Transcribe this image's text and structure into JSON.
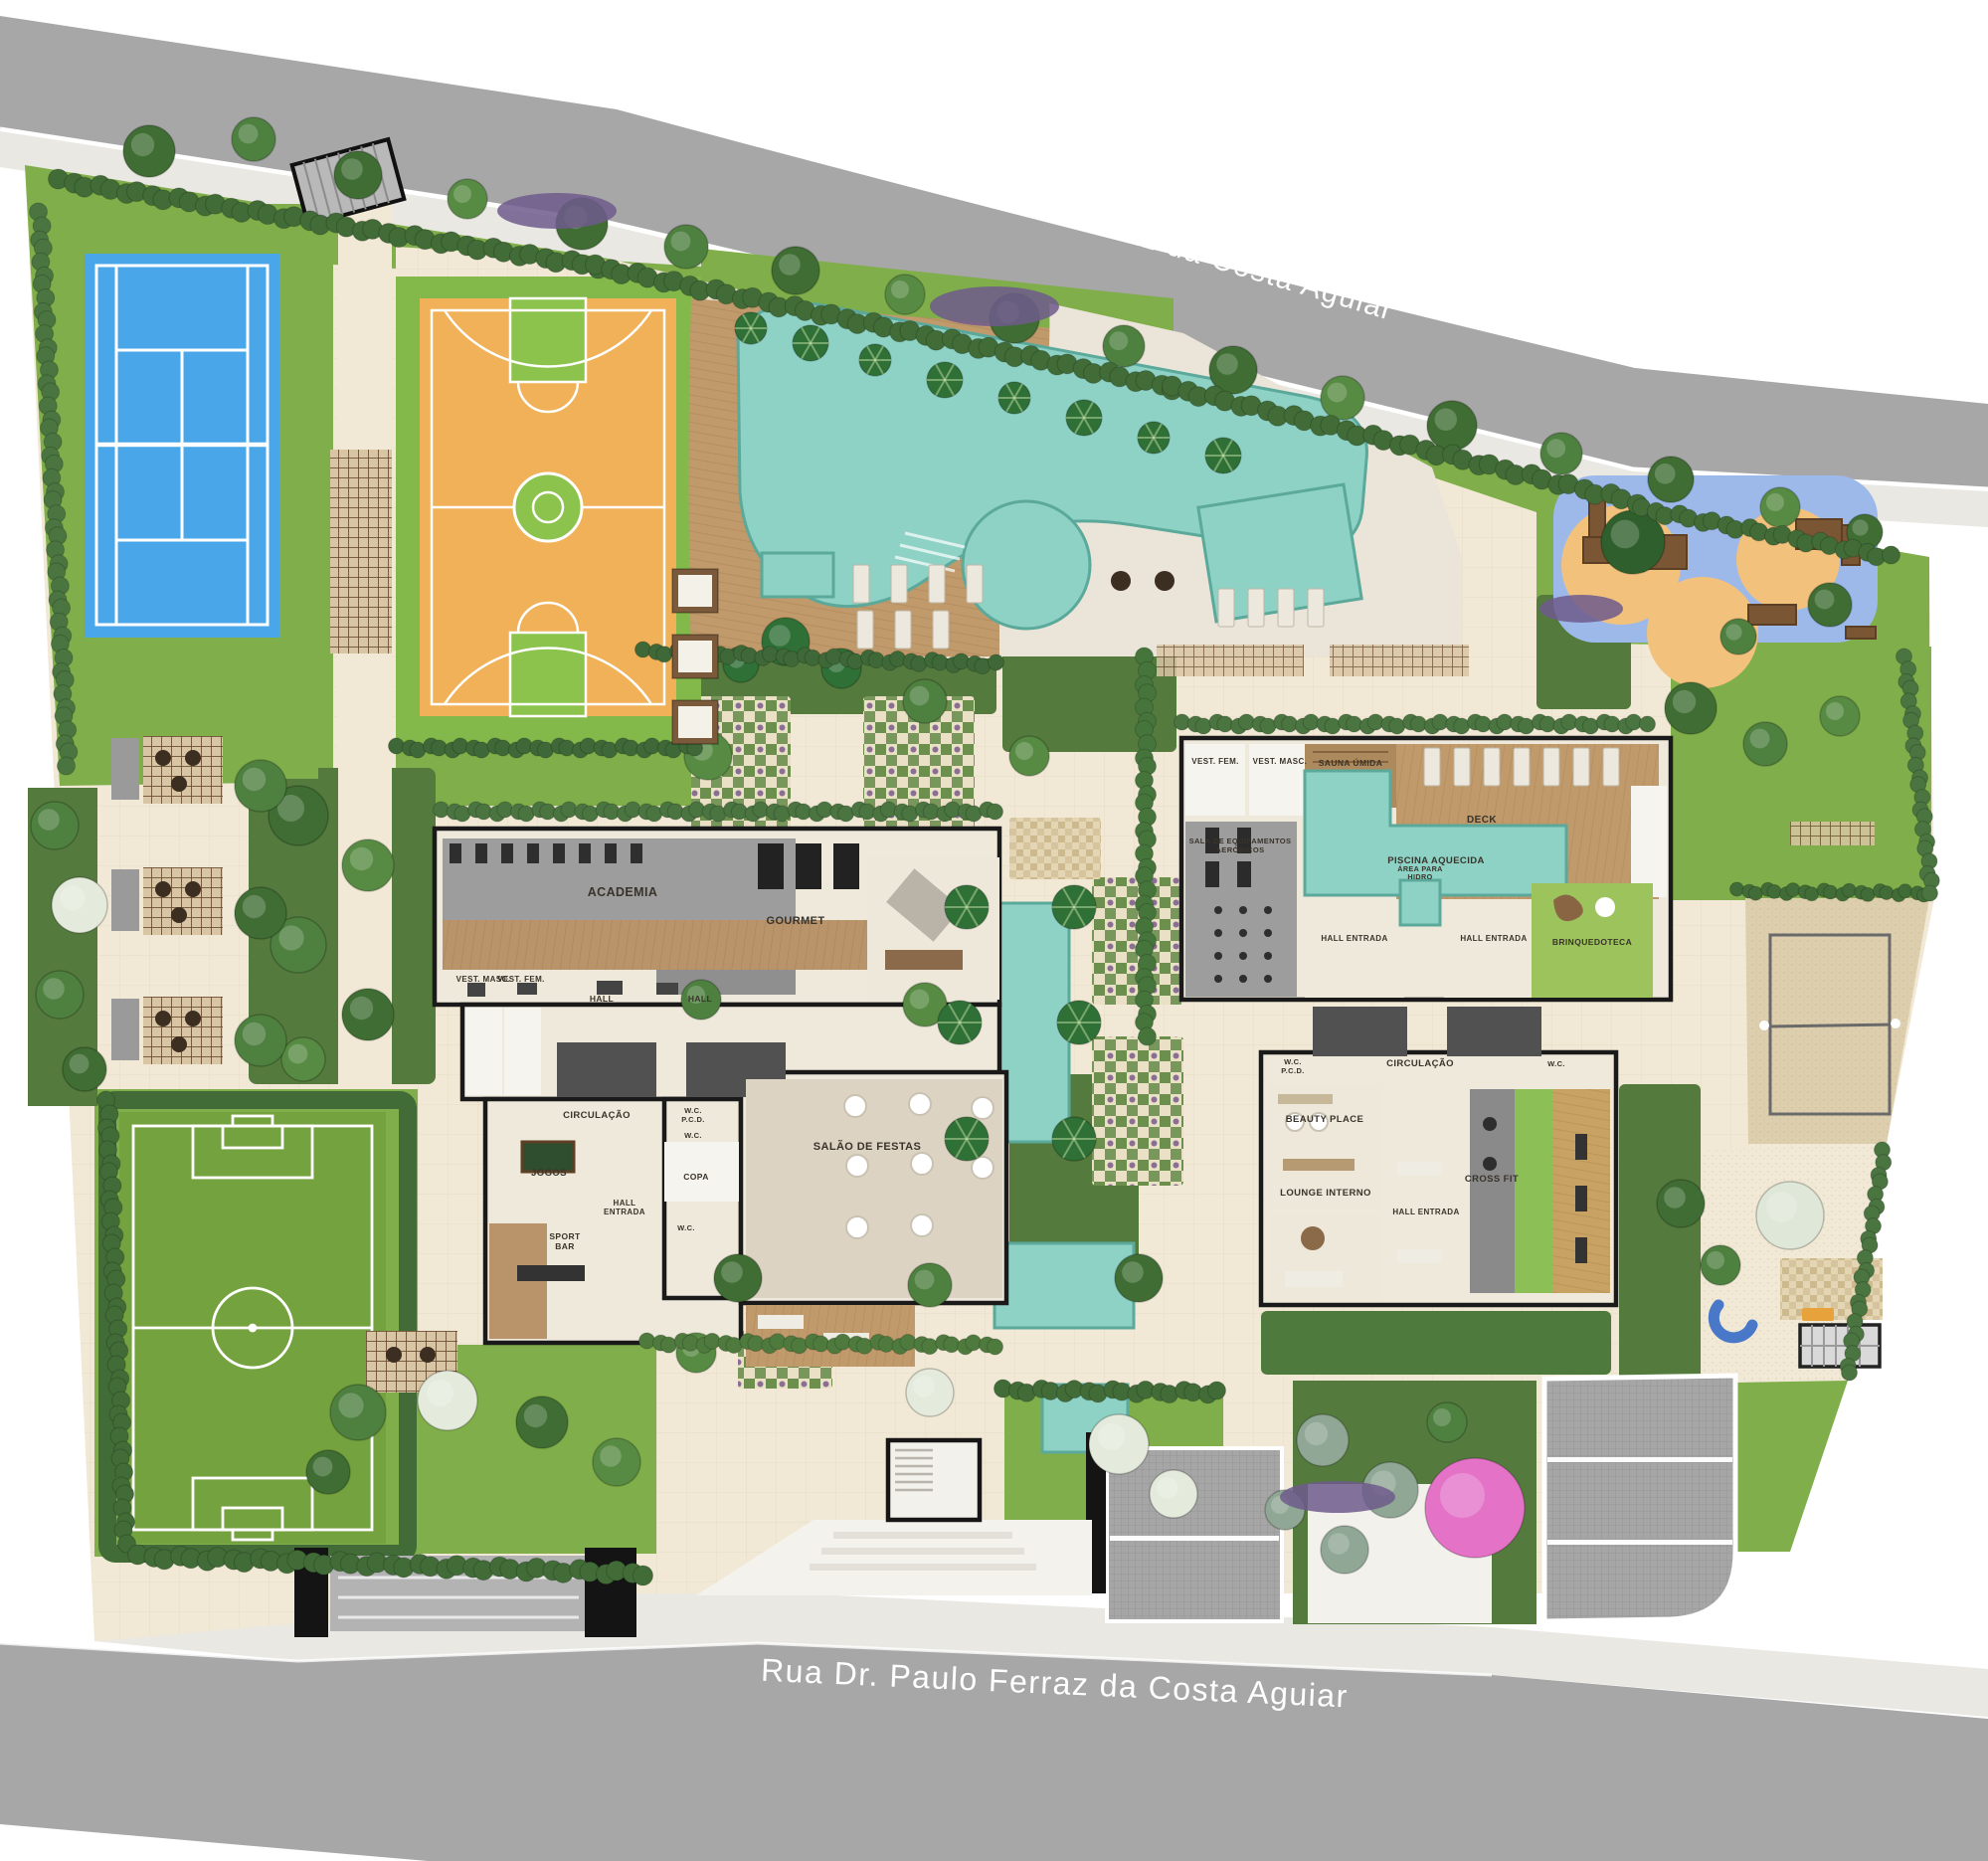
{
  "streets": {
    "top": "Rua Dr. Paulo Ferraz da Costa Aguiar",
    "bottom": "Rua Dr. Paulo Ferraz da Costa Aguiar"
  },
  "labels": {
    "street_top": "Rua Dr. Paulo Ferraz da Costa Aguiar",
    "street_bottom": "Rua Dr. Paulo Ferraz da Costa Aguiar",
    "academia": "ACADEMIA",
    "gourmet": "GOURMET",
    "vest_masc_1": "VEST. MASC.",
    "vest_fem_1": "VEST. FEM.",
    "hall_1": "HALL",
    "hall_2": "HALL",
    "circulacao_1": "CIRCULAÇÃO",
    "wc_1": "W.C.",
    "pcd_1": "P.C.D.",
    "wc_2": "W.C.",
    "salao_festas": "SALÃO DE FESTAS",
    "jogos": "JOGOS",
    "copa": "COPA",
    "hall_entrada_1a": "HALL",
    "hall_entrada_1b": "ENTRADA",
    "wc_3": "W.C.",
    "sport_1": "SPORT",
    "sport_2": "BAR",
    "vest_fem_2": "VEST. FEM.",
    "vest_masc_2": "VEST. MASC.",
    "sauna": "SAUNA ÚMIDA",
    "deck": "DECK",
    "piscina_aquecida": "PISCINA AQUECIDA",
    "sala_equip_1": "SALA DE EQUIPAMENTOS",
    "sala_equip_2": "AERÓBICOS",
    "area_hidro_1": "ÁREA PARA",
    "area_hidro_2": "HIDRO",
    "hall_entrada_2": "HALL ENTRADA",
    "hall_entrada_3": "HALL ENTRADA",
    "brinquedoteca": "BRINQUEDOTECA",
    "wc_4": "W.C.",
    "pcd_2": "P.C.D.",
    "circulacao_2": "CIRCULAÇÃO",
    "wc_5": "W.C.",
    "beauty_place": "BEAUTY PLACE",
    "cross_fit": "CROSS FIT",
    "lounge_interno": "LOUNGE INTERNO",
    "hall_entrada_4": "HALL ENTRADA"
  },
  "facilities": [
    "tennis-court",
    "basketball-court",
    "main-pool",
    "spa-circle",
    "kids-pool",
    "playground",
    "soccer-field",
    "beach-volleyball-court",
    "bbq-pergolas",
    "gym",
    "party-hall",
    "sport-bar",
    "games-room",
    "gourmet-room",
    "heated-pool",
    "wet-sauna",
    "cross-fit",
    "beauty-place",
    "toy-room",
    "entrance-lobby",
    "garage-ramps",
    "reflecting-pools"
  ],
  "palette": {
    "road": "#a7a7a7",
    "sidewalk": "#eae8e2",
    "paving": "#f1e9d5",
    "pathLight": "#f6efdf",
    "lawn": "#7fae4a",
    "lawnDark": "#699943",
    "field": "#74a23e",
    "hedge": "#416b37",
    "gardenDark": "#557a3d",
    "water": "#8ed1c5",
    "waterEdge": "#5ba99b",
    "deckWood": "#c19a6b",
    "wood": "#b9936a",
    "sauna": "#ad8a5e",
    "courtBlue": "#49a7e9",
    "courtOrange": "#f0b158",
    "courtGreen": "#8cc34d",
    "sand": "#ddcfae",
    "gravel": "#e9e0ca",
    "playBlue": "#9cb9e9",
    "playOrange": "#f2c27d",
    "wall": "#1a1a1a",
    "floor": "#efe9db",
    "floorGray": "#9d9d9d",
    "coreGray": "#515151",
    "roomWhite": "#f6f4ee",
    "driveway": "#a6a6a6",
    "labelInk": "#39332a",
    "purple": "#6f5b8c",
    "pink": "#e473c8",
    "whiteTree": "#e4ebdd"
  }
}
